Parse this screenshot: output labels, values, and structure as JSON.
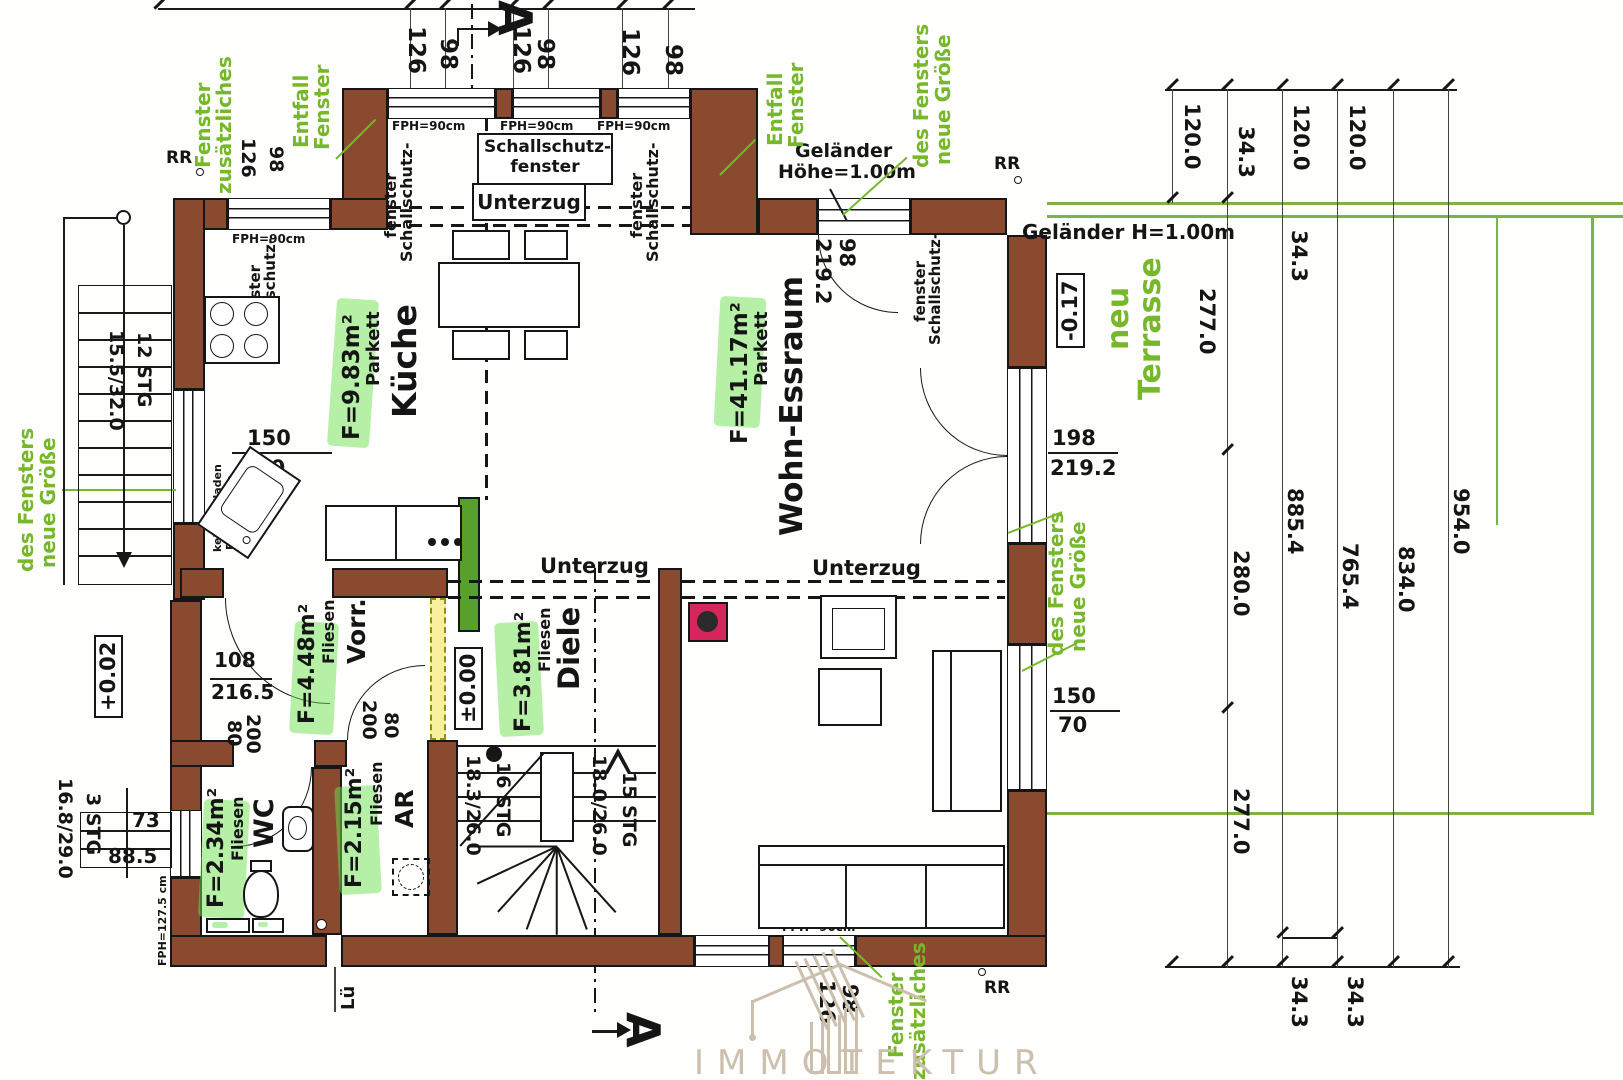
{
  "ann": {
    "z1a": "zusätzliches",
    "z1b": "Fenster",
    "e1a": "Fenster",
    "e1b": "Entfall",
    "e2a": "Fenster",
    "e2b": "Entfall",
    "n1a": "neue Größe",
    "n1b": "des Fensters",
    "n2a": "neue Größe",
    "n2b": "des Fensters",
    "n3a": "neue Größe",
    "n3b": "des Fensters",
    "z2a": "zusätzliches",
    "z2b": "Fenster",
    "ta": "Terrasse",
    "tb": "neu"
  },
  "rooms": {
    "kueche": {
      "name": "Küche",
      "floor": "Parkett",
      "area": "F=9.83m²"
    },
    "wohn": {
      "name": "Wohn-Essraum",
      "floor": "Parkett",
      "area": "F=41.17m²"
    },
    "diele": {
      "name": "Diele",
      "floor": "Fliesen",
      "area": "F=3.81m²"
    },
    "vorr": {
      "name": "Vorr.",
      "floor": "Fliesen",
      "area": "F=4.48m²"
    },
    "wc": {
      "name": "WC",
      "floor": "Fliesen",
      "area": "F=2.34m²"
    },
    "ar": {
      "name": "AR",
      "floor": "Fliesen",
      "area": "F=2.15m²"
    }
  },
  "levels": {
    "terrace": "-0.17",
    "entry": "+0.02",
    "ground": "±0.00"
  },
  "lb": {
    "ss1": "Schallschutz-",
    "ss2": "fenster",
    "uz": "Unterzug",
    "g1": "Geländer",
    "g2": "Höhe=1.00m",
    "gh": "Geländer H=1.00m",
    "rr": "RR",
    "lue": "Lü",
    "fph90": "FPH=90cm",
    "fph146": "FPH=146cm",
    "kr": "kein Rollladen",
    "fph145": "FPH=145cm",
    "fph1275": "FPH=127.5 cm",
    "secA": "A"
  },
  "st": {
    "s12": "12 STG",
    "v12": "15.5/32.0",
    "s16": "16 STG",
    "v16": "18.3/26.0",
    "s15": "15 STG",
    "v15": "18.0/26.0",
    "s3": "3 STG",
    "v3": "16.8/29.0"
  },
  "dm": {
    "top": [
      "126",
      "98",
      "126",
      "98",
      "126",
      "98"
    ],
    "kw": [
      "126",
      "98"
    ],
    "bd98": "98",
    "bd219": "219.2",
    "rd198": "198",
    "rd219": "219.2",
    "rw150": "150",
    "rw70": "70",
    "lw150": "150",
    "lw70": "70",
    "vd108": "108",
    "vd216": "216.5",
    "w80": "80",
    "w200": "200",
    "a80": "80",
    "a200": "200",
    "bw": [
      "126",
      "98"
    ],
    "s73": "73",
    "s885": "88.5",
    "ct": [
      "120.0",
      "34.3",
      "120.0",
      "120.0"
    ],
    "c343": "34.3",
    "c1": [
      "277.0",
      "280.0",
      "277.0"
    ],
    "tot": [
      "885.4",
      "765.4",
      "834.0",
      "954.0"
    ],
    "cb": [
      "34.3",
      "34.3"
    ]
  },
  "watermark": {
    "t": "IMMOTEKTUR"
  },
  "colors": {
    "green": "#76b82a",
    "wall": "#8a4a2f",
    "terrace": "#7cb342",
    "highlight": "rgba(110,225,80,0.5)",
    "chimney": "#d6275c",
    "watermark": "#cdbfae"
  }
}
